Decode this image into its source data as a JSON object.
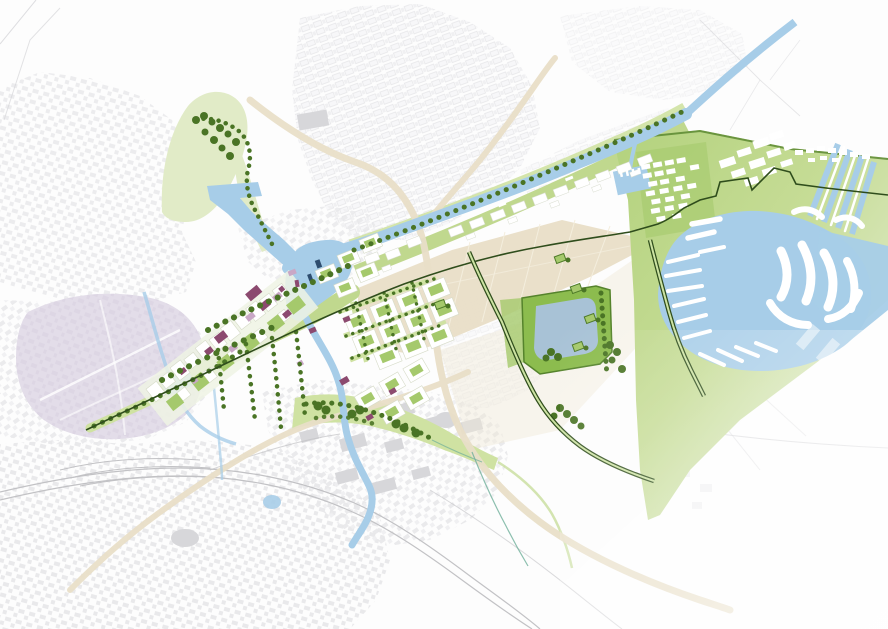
{
  "map": {
    "kind": "urban-waterfront-masterplan",
    "palette": {
      "background": "#fdfdfd",
      "fabric": "#e8e8ea",
      "fabric_light": "#efeff1",
      "fabric_dark": "#d7d7da",
      "city_center": "#e3dde9",
      "city_texture": "#d8d1e0",
      "water": "#a7cde8",
      "water_lake": "#a8c2d6",
      "water_navy": "#2e4d6e",
      "green_pale": "#e1ebc7",
      "green_soft": "#cfe2a2",
      "green_mid": "#c0d88e",
      "green_bright": "#a5c96c",
      "green_park": "#8cbc4e",
      "green_deep": "#55832c",
      "tree": "#4a7425",
      "route": "#2f4d1c",
      "route_inner": "#cde3a3",
      "beige_zone": "#e8ddc6",
      "beige_road": "#e9dfc8",
      "beige_tint": "#efe9d8",
      "field_line": "#f4eede",
      "plum": "#8c4a6f",
      "pink": "#c9a8c6",
      "white": "#ffffff",
      "rail": "#c2c2c5",
      "hairline": "#d6d6d9",
      "stream": "#6faf9a",
      "marina_fade_start": "#b3d27d",
      "marina_fade_mid": "#c6dc96",
      "marina_fade_end": "#edf3e4"
    },
    "features": [
      {
        "name": "urban-fabric",
        "kind": "existing-city"
      },
      {
        "name": "historic-city-center",
        "kind": "district"
      },
      {
        "name": "main-canal",
        "kind": "waterway"
      },
      {
        "name": "canal-tree-avenue",
        "kind": "tree-row"
      },
      {
        "name": "harbor-basin",
        "kind": "waterway"
      },
      {
        "name": "old-harbor",
        "kind": "waterway"
      },
      {
        "name": "river",
        "kind": "waterway"
      },
      {
        "name": "ring-canal",
        "kind": "waterway"
      },
      {
        "name": "central-development-spine",
        "kind": "new-development"
      },
      {
        "name": "garden-district",
        "kind": "new-development"
      },
      {
        "name": "canal-side-plots",
        "kind": "new-development"
      },
      {
        "name": "marina-lake",
        "kind": "waterway"
      },
      {
        "name": "marina-piers",
        "kind": "new-development"
      },
      {
        "name": "marina-housing",
        "kind": "new-development"
      },
      {
        "name": "waterfront-green",
        "kind": "landscape"
      },
      {
        "name": "country-estate-lake",
        "kind": "waterway"
      },
      {
        "name": "estate-park",
        "kind": "landscape"
      },
      {
        "name": "agricultural-fields",
        "kind": "landscape"
      },
      {
        "name": "farmsteads",
        "kind": "landscape"
      },
      {
        "name": "green-wedge-park",
        "kind": "landscape"
      },
      {
        "name": "south-green-corridor",
        "kind": "landscape"
      },
      {
        "name": "west-green-arm",
        "kind": "landscape"
      },
      {
        "name": "west-avenue",
        "kind": "route"
      },
      {
        "name": "east-avenue",
        "kind": "route"
      },
      {
        "name": "dike-route",
        "kind": "route"
      },
      {
        "name": "railway",
        "kind": "infrastructure"
      },
      {
        "name": "regional-roads",
        "kind": "infrastructure"
      },
      {
        "name": "water-sport-lanes",
        "kind": "waterway"
      }
    ]
  }
}
